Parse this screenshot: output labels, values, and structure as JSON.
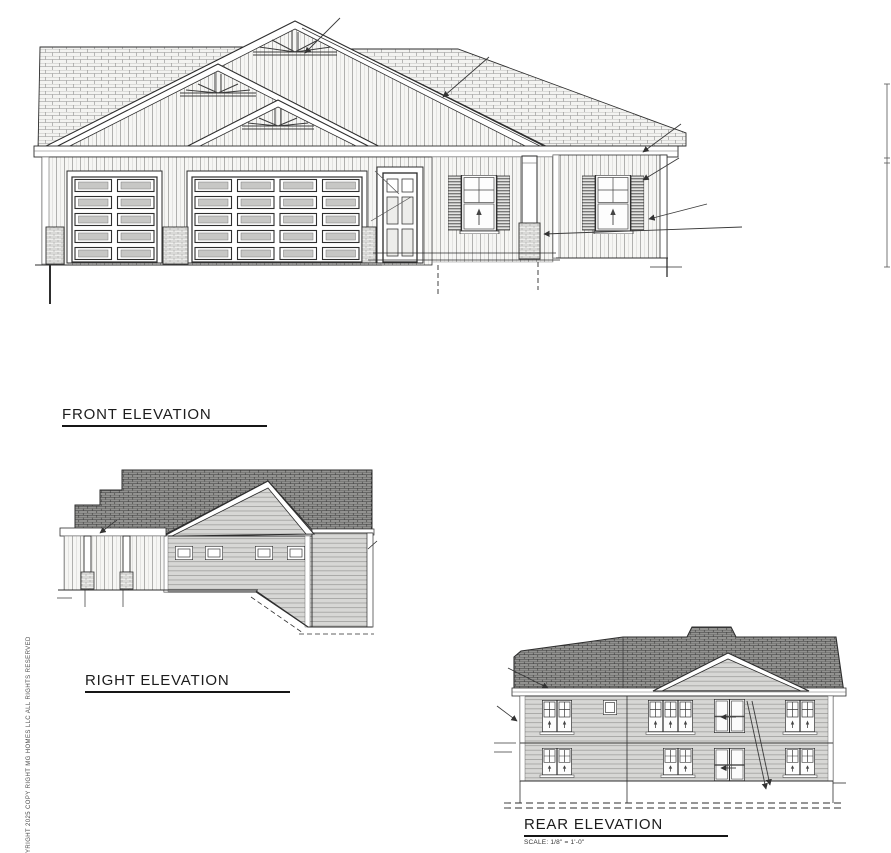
{
  "page": {
    "width": 891,
    "height": 853,
    "background": "#ffffff"
  },
  "titles": {
    "front": {
      "label": "FRONT ELEVATION"
    },
    "right": {
      "label": "RIGHT ELEVATION"
    },
    "rear": {
      "label": "REAR ELEVATION",
      "scale_note": "SCALE: 1/8\" = 1'-0\""
    }
  },
  "margin_text": {
    "copyright_vertical": "YRIGHT 2025 COPY RIGHT MG HOMES LLC ALL RIGHTS RESERVED"
  },
  "drawing": {
    "type": "residential-house-elevation-blueprints",
    "views": [
      {
        "name": "front-elevation",
        "features": [
          "triple gable roof with decorative sunburst trusses",
          "board-and-batten gable siding",
          "single garage door (2x5 panels)",
          "double garage door (4x5 panels)",
          "panelled entry door with two top lites",
          "two double-hung windows with louvered shutters",
          "brick piers",
          "porch column",
          "right wing with lower roof",
          "vertical dimension line at right"
        ]
      },
      {
        "name": "right-elevation",
        "features": [
          "stepped dark shingle roof",
          "side gable with horizontal lap siding",
          "four small windows",
          "two porch posts on brick piers",
          "grade sloping down to walkout basement corner"
        ]
      },
      {
        "name": "rear-elevation",
        "features": [
          "two-story walkout rear wall",
          "center cross gable",
          "horizontal lap siding",
          "upper and lower sliding patio doors with swing leaders",
          "double and triple grid windows",
          "small square window",
          "dashed footing line"
        ]
      }
    ],
    "colors": {
      "line": "#2e2e2e",
      "roof_dark": "#909090",
      "roof_light": "#f3f3f1",
      "siding_lap": "#d7d7d5",
      "siding_batten": "#f6f6f4",
      "brick": "#eeeeec"
    }
  }
}
